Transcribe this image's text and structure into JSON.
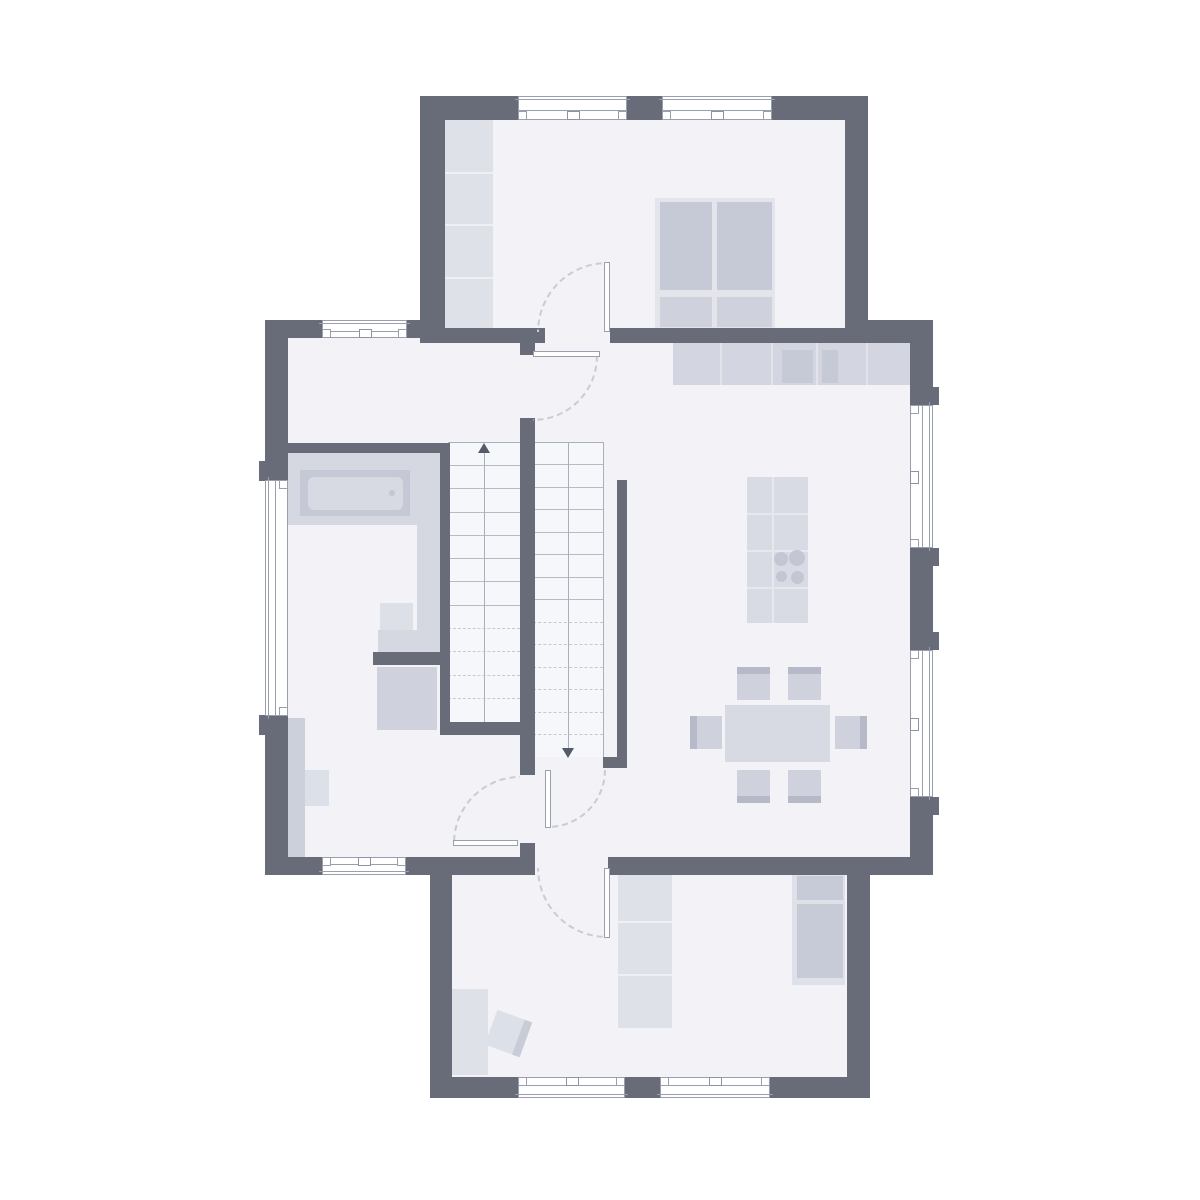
{
  "palette": {
    "wall": "#686c78",
    "floor": "#f2f2f7",
    "stair_bg": "#f6f7fa",
    "frame_line": "#999fad",
    "tread_solid": "#b7bbc7",
    "tread_dash": "#c6c9d3",
    "guide": "#abafbb",
    "arrow": "#565b69",
    "arc": "#c9ccd6",
    "furn_light": "#dfe1e9",
    "furn_frame": "#e3e5eb",
    "furn_med": "#d3d6e0",
    "furn_med2": "#cfd2dd",
    "furn_dark": "#c6cad6",
    "band": "#b6bac8",
    "divider": "#eef0f4",
    "counter_div": "#e2e4ea",
    "platform": "#d5d8e1",
    "tub_outer": "#c5c9d5",
    "tub_inner": "#d7dae2",
    "basin": "#dde0e7",
    "sideboard": "#ccd0db",
    "cabinet_panel": "#c7cbd7",
    "island": "#d8dbe4",
    "island_line": "#e6e8ee",
    "burner": "#c3c7d4",
    "table": "#d7dae3",
    "stool": "#dce0e8",
    "stool_edge": "#c8ccd6"
  },
  "floors": [
    {
      "name": "floor-bedroom",
      "x": 445,
      "y": 120,
      "w": 400,
      "h": 210
    },
    {
      "name": "floor-main",
      "x": 288,
      "y": 338,
      "w": 622,
      "h": 519
    },
    {
      "name": "floor-utility",
      "x": 452,
      "y": 875,
      "w": 395,
      "h": 202
    },
    {
      "name": "floor-opening-bedroom",
      "x": 545,
      "y": 328,
      "w": 65,
      "h": 12
    },
    {
      "name": "floor-opening-utility",
      "x": 535,
      "y": 857,
      "w": 73,
      "h": 18
    }
  ],
  "walls": [
    {
      "name": "bedroom-wall-top-1",
      "x": 420,
      "y": 96,
      "w": 98,
      "h": 24
    },
    {
      "name": "bedroom-wall-top-2",
      "x": 627,
      "y": 96,
      "w": 35,
      "h": 24
    },
    {
      "name": "bedroom-wall-top-3",
      "x": 772,
      "y": 96,
      "w": 96,
      "h": 24
    },
    {
      "name": "bedroom-wall-left",
      "x": 420,
      "y": 120,
      "w": 25,
      "h": 223
    },
    {
      "name": "bedroom-wall-right",
      "x": 845,
      "y": 120,
      "w": 23,
      "h": 223
    },
    {
      "name": "bedroom-wall-bottom-1",
      "x": 420,
      "y": 328,
      "w": 125,
      "h": 15
    },
    {
      "name": "bedroom-wall-bottom-2",
      "x": 610,
      "y": 328,
      "w": 258,
      "h": 15
    },
    {
      "name": "hall-wall-top-1",
      "x": 265,
      "y": 320,
      "w": 57,
      "h": 18
    },
    {
      "name": "hall-wall-top-2",
      "x": 407,
      "y": 320,
      "w": 33,
      "h": 18
    },
    {
      "name": "kitchen-wall-top",
      "x": 845,
      "y": 320,
      "w": 88,
      "h": 23
    },
    {
      "name": "main-wall-left-upper",
      "x": 265,
      "y": 338,
      "w": 23,
      "h": 142
    },
    {
      "name": "main-wall-left-lower",
      "x": 265,
      "y": 716,
      "w": 23,
      "h": 141
    },
    {
      "name": "main-wall-right-1",
      "x": 910,
      "y": 343,
      "w": 23,
      "h": 62
    },
    {
      "name": "main-wall-right-2",
      "x": 910,
      "y": 548,
      "w": 23,
      "h": 102
    },
    {
      "name": "main-wall-right-3",
      "x": 910,
      "y": 797,
      "w": 23,
      "h": 60
    },
    {
      "name": "main-wall-bottom-1",
      "x": 265,
      "y": 857,
      "w": 57,
      "h": 18
    },
    {
      "name": "main-wall-bottom-2",
      "x": 406,
      "y": 857,
      "w": 129,
      "h": 18
    },
    {
      "name": "main-wall-bottom-3",
      "x": 608,
      "y": 857,
      "w": 325,
      "h": 18
    },
    {
      "name": "bath-wall-top",
      "x": 265,
      "y": 443,
      "w": 185,
      "h": 10
    },
    {
      "name": "stair-wall-left",
      "x": 440,
      "y": 453,
      "w": 10,
      "h": 282
    },
    {
      "name": "stair-wall-bottom",
      "x": 440,
      "y": 722,
      "w": 93,
      "h": 13
    },
    {
      "name": "spine-stub-top",
      "x": 520,
      "y": 337,
      "w": 15,
      "h": 18
    },
    {
      "name": "spine-wall",
      "x": 520,
      "y": 418,
      "w": 15,
      "h": 357
    },
    {
      "name": "spine-stub-bottom",
      "x": 520,
      "y": 843,
      "w": 15,
      "h": 14
    },
    {
      "name": "kitchen-side-wall",
      "x": 617,
      "y": 480,
      "w": 10,
      "h": 277
    },
    {
      "name": "kitchen-side-wall-foot",
      "x": 603,
      "y": 757,
      "w": 24,
      "h": 11
    },
    {
      "name": "bath-partition",
      "x": 373,
      "y": 652,
      "w": 77,
      "h": 13
    },
    {
      "name": "utility-wall-left",
      "x": 430,
      "y": 875,
      "w": 22,
      "h": 223
    },
    {
      "name": "utility-wall-right",
      "x": 847,
      "y": 875,
      "w": 23,
      "h": 223
    },
    {
      "name": "utility-wall-bottom-1",
      "x": 430,
      "y": 1077,
      "w": 88,
      "h": 21
    },
    {
      "name": "utility-wall-bottom-2",
      "x": 625,
      "y": 1077,
      "w": 35,
      "h": 21
    },
    {
      "name": "utility-wall-bottom-3",
      "x": 770,
      "y": 1077,
      "w": 100,
      "h": 21
    },
    {
      "name": "jamb-nub-left-1",
      "x": 259,
      "y": 461,
      "w": 6,
      "h": 20
    },
    {
      "name": "jamb-nub-left-2",
      "x": 259,
      "y": 715,
      "w": 6,
      "h": 20
    },
    {
      "name": "jamb-nub-right-1",
      "x": 933,
      "y": 387,
      "w": 6,
      "h": 18
    },
    {
      "name": "jamb-nub-right-2",
      "x": 933,
      "y": 548,
      "w": 6,
      "h": 18
    },
    {
      "name": "jamb-nub-right-3",
      "x": 933,
      "y": 632,
      "w": 6,
      "h": 18
    },
    {
      "name": "jamb-nub-right-4",
      "x": 933,
      "y": 797,
      "w": 6,
      "h": 18
    }
  ],
  "stairs": {
    "bg": [
      {
        "name": "stair-flight-up-bg",
        "x": 448,
        "y": 442,
        "w": 72,
        "h": 280
      },
      {
        "name": "stair-flight-down-bg",
        "x": 533,
        "y": 442,
        "w": 70,
        "h": 315
      }
    ],
    "flights": [
      {
        "name": "stair-flight-up",
        "x": 448,
        "w": 72,
        "yStart": 465,
        "yEnd": 700,
        "step": 23.3,
        "dashFrom": 622
      },
      {
        "name": "stair-flight-down",
        "x": 533,
        "w": 70,
        "yStart": 464,
        "yEnd": 735,
        "step": 22.5,
        "dashFrom": 620
      }
    ],
    "outlines": [
      {
        "name": "stair-outline-top",
        "x": 448,
        "y": 442,
        "w": 155,
        "h": 1
      },
      {
        "name": "stair-outline-right",
        "x": 603,
        "y": 442,
        "w": 1,
        "h": 316
      }
    ],
    "guides": [
      {
        "name": "stair-guide-up",
        "x": 484,
        "y": 450,
        "h": 272
      },
      {
        "name": "stair-guide-down",
        "x": 568,
        "y": 442,
        "h": 306
      }
    ],
    "arrows": [
      {
        "name": "stair-arrow-up",
        "x": 484,
        "y": 443,
        "dir": "up"
      },
      {
        "name": "stair-arrow-down",
        "x": 568,
        "y": 748,
        "dir": "down"
      }
    ]
  },
  "furniture": [
    {
      "name": "bedroom-wardrobe",
      "x": 440,
      "y": 120,
      "w": 53,
      "h": 208,
      "fill": "furn_light",
      "parts": [
        {
          "dx": 0,
          "dy": 52,
          "w": 53,
          "h": 2,
          "fill": "divider"
        },
        {
          "dx": 0,
          "dy": 104,
          "w": 53,
          "h": 2,
          "fill": "divider"
        },
        {
          "dx": 0,
          "dy": 157,
          "w": 53,
          "h": 2,
          "fill": "divider"
        }
      ]
    },
    {
      "name": "double-bed",
      "x": 655,
      "y": 198,
      "w": 120,
      "h": 132,
      "fill": "furn_frame",
      "parts": [
        {
          "dx": 5,
          "dy": 4,
          "w": 52,
          "h": 88,
          "fill": "furn_dark"
        },
        {
          "dx": 62,
          "dy": 4,
          "w": 55,
          "h": 88,
          "fill": "furn_dark"
        },
        {
          "dx": 5,
          "dy": 99,
          "w": 52,
          "h": 30,
          "fill": "furn_med2"
        },
        {
          "dx": 62,
          "dy": 99,
          "w": 55,
          "h": 30,
          "fill": "furn_med2"
        }
      ]
    },
    {
      "name": "kitchen-counter",
      "x": 673,
      "y": 343,
      "w": 237,
      "h": 42,
      "fill": "furn_med",
      "parts": [
        {
          "dx": 47,
          "dy": 0,
          "w": 2,
          "h": 42,
          "fill": "counter_div"
        },
        {
          "dx": 98,
          "dy": 0,
          "w": 2,
          "h": 42,
          "fill": "counter_div"
        },
        {
          "dx": 143,
          "dy": 0,
          "w": 2,
          "h": 42,
          "fill": "counter_div"
        },
        {
          "dx": 193,
          "dy": 0,
          "w": 2,
          "h": 42,
          "fill": "counter_div"
        },
        {
          "dx": 109,
          "dy": 7,
          "w": 31,
          "h": 33,
          "fill": "furn_dark"
        },
        {
          "dx": 149,
          "dy": 7,
          "w": 16,
          "h": 33,
          "fill": "furn_dark"
        }
      ]
    },
    {
      "name": "kitchen-island",
      "x": 747,
      "y": 477,
      "w": 61,
      "h": 146,
      "fill": "island",
      "parts": [
        {
          "dx": 0,
          "dy": 36,
          "w": 61,
          "h": 2,
          "fill": "island_line"
        },
        {
          "dx": 0,
          "dy": 73,
          "w": 61,
          "h": 2,
          "fill": "island_line"
        },
        {
          "dx": 0,
          "dy": 110,
          "w": 61,
          "h": 2,
          "fill": "island_line"
        },
        {
          "dx": 25,
          "dy": 0,
          "w": 2,
          "h": 146,
          "fill": "island_line"
        }
      ],
      "circles": [
        {
          "cx": 34,
          "cy": 82,
          "r": 7,
          "fill": "burner"
        },
        {
          "cx": 50,
          "cy": 81,
          "r": 8,
          "fill": "burner"
        },
        {
          "cx": 34,
          "cy": 99,
          "r": 5.5,
          "fill": "burner"
        },
        {
          "cx": 50,
          "cy": 100,
          "r": 6.5,
          "fill": "burner"
        }
      ]
    },
    {
      "name": "dining-table",
      "x": 725,
      "y": 705,
      "w": 105,
      "h": 57,
      "fill": "table"
    },
    {
      "name": "dining-chair-top-left",
      "x": 737,
      "y": 667,
      "w": 33,
      "h": 33,
      "fill": "furn_med2",
      "parts": [
        {
          "dx": 0,
          "dy": 0,
          "w": 33,
          "h": 7,
          "fill": "band"
        }
      ]
    },
    {
      "name": "dining-chair-top-right",
      "x": 788,
      "y": 667,
      "w": 33,
      "h": 33,
      "fill": "furn_med2",
      "parts": [
        {
          "dx": 0,
          "dy": 0,
          "w": 33,
          "h": 7,
          "fill": "band"
        }
      ]
    },
    {
      "name": "dining-chair-bottom-left",
      "x": 737,
      "y": 770,
      "w": 33,
      "h": 33,
      "fill": "furn_med2",
      "parts": [
        {
          "dx": 0,
          "dy": 26,
          "w": 33,
          "h": 7,
          "fill": "band"
        }
      ]
    },
    {
      "name": "dining-chair-bottom-right",
      "x": 788,
      "y": 770,
      "w": 33,
      "h": 33,
      "fill": "furn_med2",
      "parts": [
        {
          "dx": 0,
          "dy": 26,
          "w": 33,
          "h": 7,
          "fill": "band"
        }
      ]
    },
    {
      "name": "dining-chair-left",
      "x": 690,
      "y": 716,
      "w": 32,
      "h": 33,
      "fill": "furn_med2",
      "parts": [
        {
          "dx": 0,
          "dy": 0,
          "w": 7,
          "h": 33,
          "fill": "band"
        }
      ]
    },
    {
      "name": "dining-chair-right",
      "x": 835,
      "y": 716,
      "w": 32,
      "h": 33,
      "fill": "furn_med2",
      "parts": [
        {
          "dx": 25,
          "dy": 0,
          "w": 7,
          "h": 33,
          "fill": "band"
        }
      ]
    },
    {
      "name": "bath-platform",
      "x": 288,
      "y": 452,
      "w": 152,
      "h": 73,
      "fill": "platform"
    },
    {
      "name": "bath-side-counter",
      "x": 417,
      "y": 525,
      "w": 23,
      "h": 127,
      "fill": "platform"
    },
    {
      "name": "bath-basin-counter",
      "x": 378,
      "y": 630,
      "w": 62,
      "h": 22,
      "fill": "platform"
    },
    {
      "name": "bath-basin",
      "x": 380,
      "y": 603,
      "w": 33,
      "h": 27,
      "fill": "basin"
    },
    {
      "name": "bathtub",
      "x": 300,
      "y": 470,
      "w": 110,
      "h": 46,
      "fill": "tub_outer",
      "parts": [
        {
          "dx": 8,
          "dy": 7,
          "w": 95,
          "h": 33,
          "fill": "tub_inner",
          "radius": 6
        }
      ],
      "circles": [
        {
          "cx": 92,
          "cy": 23,
          "r": 3,
          "fill": "burner"
        }
      ]
    },
    {
      "name": "shower",
      "x": 377,
      "y": 667,
      "w": 60,
      "h": 63,
      "fill": "furn_med2"
    },
    {
      "name": "bath-sideboard",
      "x": 288,
      "y": 718,
      "w": 17,
      "h": 139,
      "fill": "sideboard"
    },
    {
      "name": "bath-sideboard-box",
      "x": 305,
      "y": 770,
      "w": 24,
      "h": 36,
      "fill": "stool"
    },
    {
      "name": "utility-wardrobe",
      "x": 618,
      "y": 875,
      "w": 54,
      "h": 153,
      "fill": "furn_light",
      "parts": [
        {
          "dx": 0,
          "dy": 46,
          "w": 54,
          "h": 2,
          "fill": "divider"
        },
        {
          "dx": 0,
          "dy": 99,
          "w": 54,
          "h": 2,
          "fill": "divider"
        }
      ]
    },
    {
      "name": "utility-cabinet",
      "x": 792,
      "y": 875,
      "w": 53,
      "h": 110,
      "fill": "furn_light",
      "parts": [
        {
          "dx": 5,
          "dy": 1,
          "w": 46,
          "h": 24,
          "fill": "cabinet_panel"
        },
        {
          "dx": 5,
          "dy": 29,
          "w": 46,
          "h": 74,
          "fill": "cabinet_panel"
        }
      ]
    },
    {
      "name": "utility-desk",
      "x": 442,
      "y": 989,
      "w": 46,
      "h": 86,
      "fill": "furn_light"
    },
    {
      "name": "utility-stool",
      "x": 490,
      "y": 1015,
      "w": 37,
      "h": 37,
      "fill": "stool",
      "rotate": 20,
      "parts": [
        {
          "dx": 29,
          "dy": 0,
          "w": 8,
          "h": 37,
          "fill": "stool_edge"
        }
      ]
    }
  ],
  "windows": [
    {
      "name": "window-bedroom-top-1",
      "x": 518,
      "y": 96,
      "w": 109,
      "h": 24,
      "orient": "h",
      "interior": "below",
      "square": true
    },
    {
      "name": "window-bedroom-top-2",
      "x": 662,
      "y": 96,
      "w": 110,
      "h": 24,
      "orient": "h",
      "interior": "below",
      "square": true
    },
    {
      "name": "window-hall-top",
      "x": 322,
      "y": 320,
      "w": 85,
      "h": 18,
      "orient": "h",
      "interior": "below",
      "square": true
    },
    {
      "name": "window-left-wall",
      "x": 265,
      "y": 480,
      "w": 23,
      "h": 236,
      "orient": "v",
      "interior": "right",
      "square": false
    },
    {
      "name": "window-right-wall-1",
      "x": 910,
      "y": 405,
      "w": 23,
      "h": 143,
      "orient": "v",
      "interior": "left",
      "square": true
    },
    {
      "name": "window-right-wall-2",
      "x": 910,
      "y": 650,
      "w": 23,
      "h": 147,
      "orient": "v",
      "interior": "left",
      "square": true
    },
    {
      "name": "window-main-bottom",
      "x": 322,
      "y": 857,
      "w": 84,
      "h": 18,
      "orient": "h",
      "interior": "above",
      "square": true
    },
    {
      "name": "window-utility-bottom-1",
      "x": 518,
      "y": 1077,
      "w": 107,
      "h": 21,
      "orient": "h",
      "interior": "above",
      "square": true
    },
    {
      "name": "window-utility-bottom-2",
      "x": 660,
      "y": 1077,
      "w": 110,
      "h": 21,
      "orient": "h",
      "interior": "above",
      "square": true
    }
  ],
  "doors": [
    {
      "name": "door-bedroom",
      "leaf": {
        "x": 604,
        "y": 262,
        "w": 6,
        "h": 70
      },
      "arc": {
        "cx": 607,
        "cy": 332,
        "r": 70,
        "quad": "nw"
      }
    },
    {
      "name": "door-kitchen",
      "leaf": {
        "x": 533,
        "y": 351,
        "w": 67,
        "h": 6
      },
      "arc": {
        "cx": 533,
        "cy": 356,
        "r": 65,
        "quad": "se"
      }
    },
    {
      "name": "door-bathroom",
      "leaf": {
        "x": 453,
        "y": 840,
        "w": 65,
        "h": 6
      },
      "arc": {
        "cx": 520,
        "cy": 843,
        "r": 67,
        "quad": "nw"
      }
    },
    {
      "name": "door-stair-hall",
      "leaf": {
        "x": 545,
        "y": 770,
        "w": 6,
        "h": 58
      },
      "arc": {
        "cx": 548,
        "cy": 770,
        "r": 58,
        "quad": "se"
      }
    },
    {
      "name": "door-utility",
      "leaf": {
        "x": 604,
        "y": 868,
        "w": 6,
        "h": 70
      },
      "arc": {
        "cx": 607,
        "cy": 868,
        "r": 70,
        "quad": "sw"
      }
    }
  ]
}
